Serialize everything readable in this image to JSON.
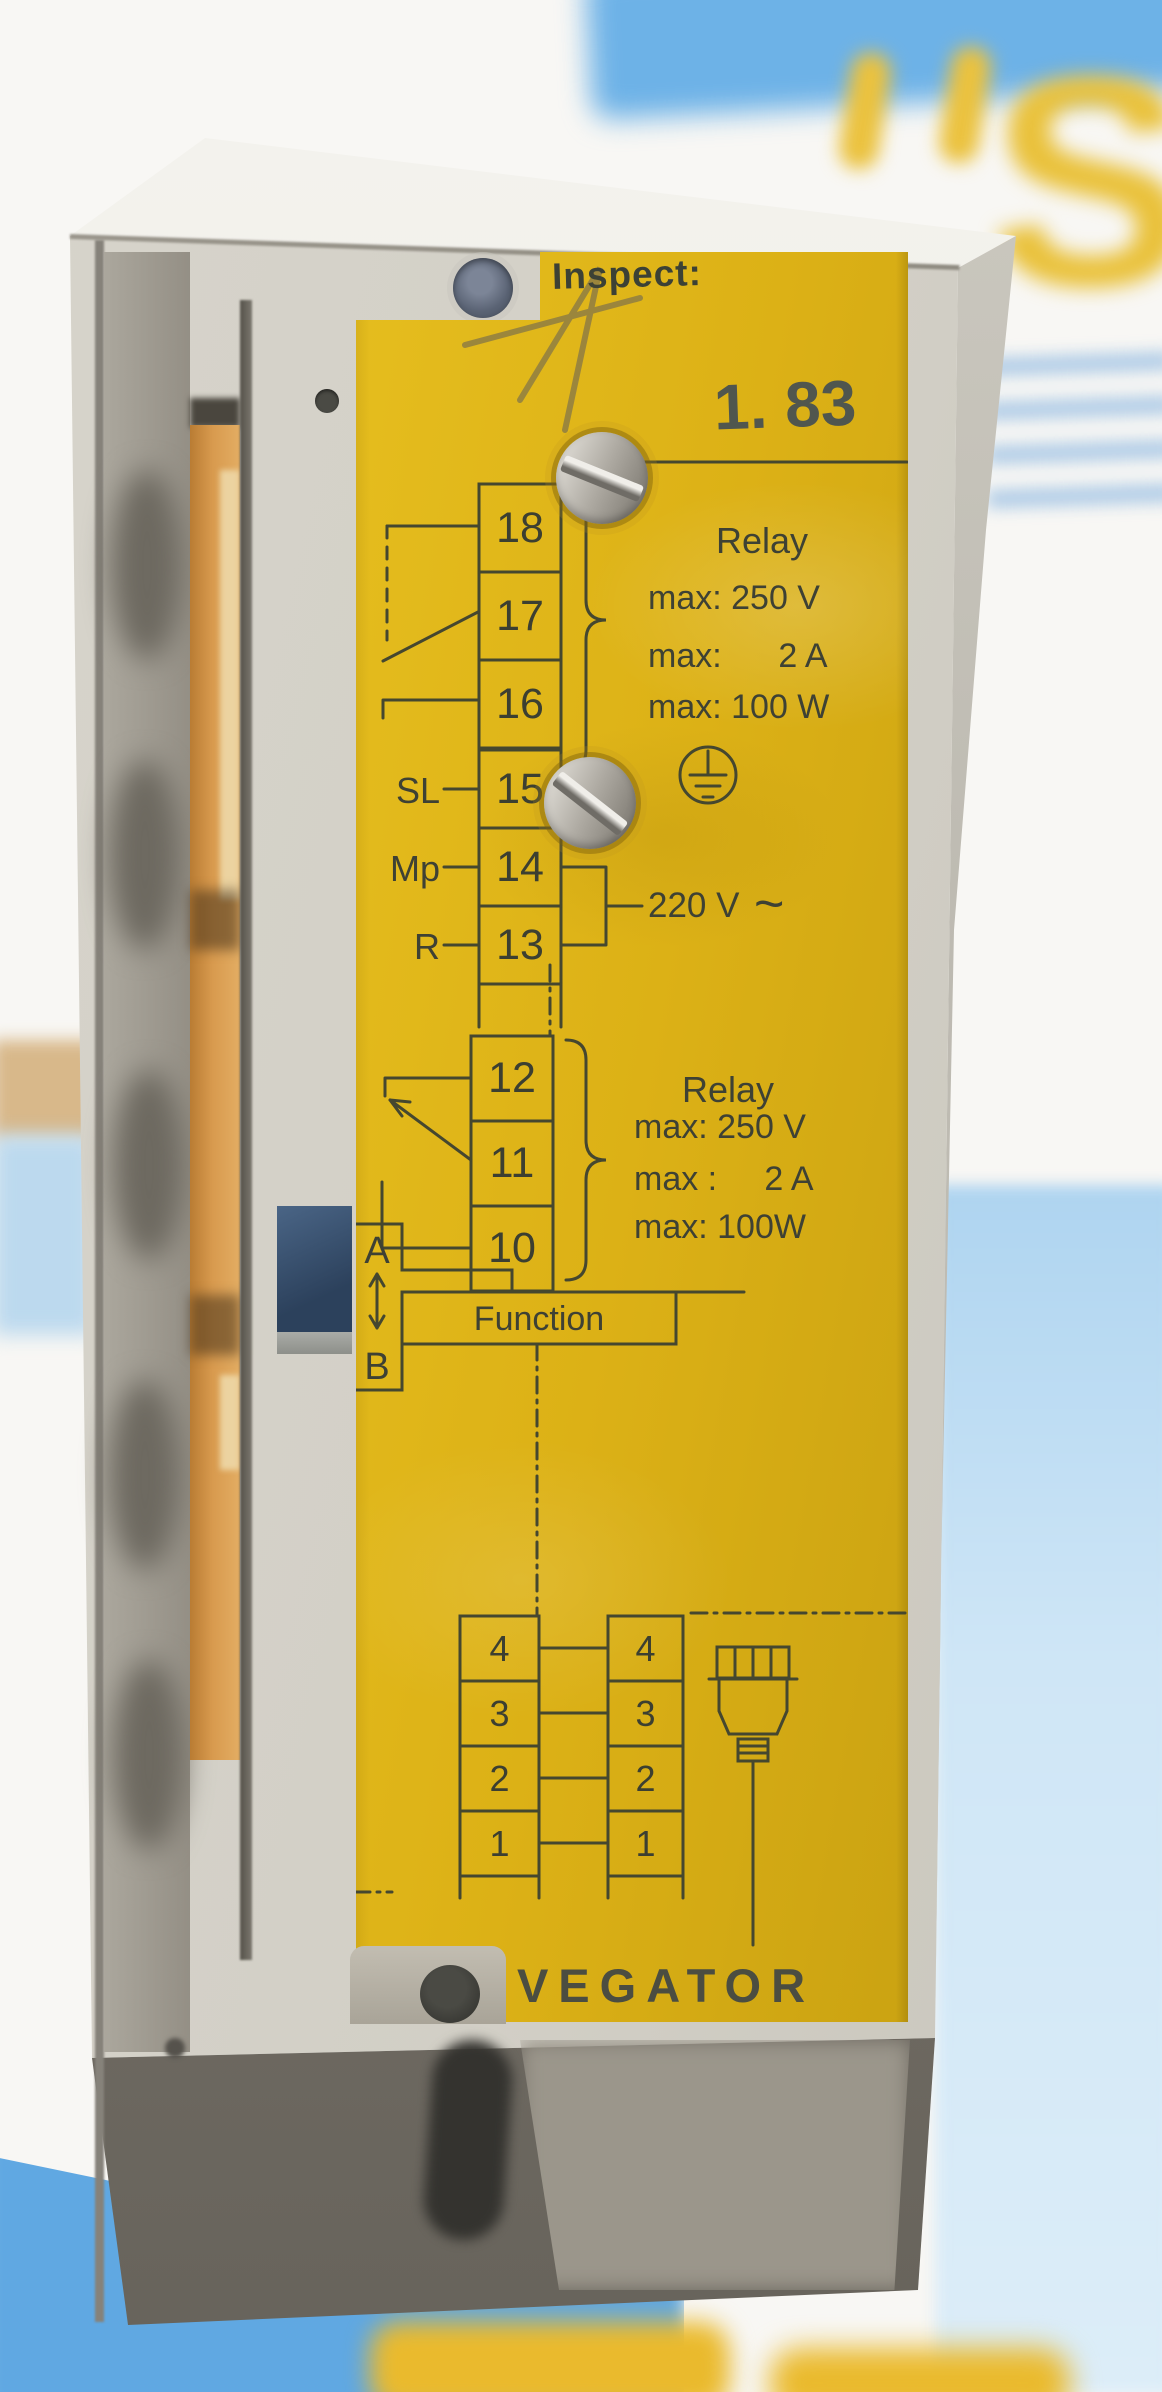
{
  "background": {
    "watermark_letter": "S"
  },
  "label": {
    "inspect": "Inspect:",
    "stamp": "1. 83",
    "brand": "VEGATOR",
    "relay_top": {
      "title": "Relay",
      "spec_voltage": "max: 250 V",
      "spec_current": "max:      2 A",
      "spec_power": "max: 100 W"
    },
    "relay_bottom": {
      "title": "Relay",
      "spec_voltage": "max: 250 V",
      "spec_current": "max :     2 A",
      "spec_power": "max: 100W"
    },
    "supply_voltage": "220 V",
    "ac_tilde": "~",
    "terminals_relay_top": [
      "18",
      "17",
      "16"
    ],
    "supply_rows": [
      {
        "label": "SL",
        "terminal": "15"
      },
      {
        "label": "Mp",
        "terminal": "14"
      },
      {
        "label": "R",
        "terminal": "13"
      }
    ],
    "function": {
      "label": "Function",
      "pos_top": "A",
      "pos_bottom": "B"
    },
    "probe_terminals_left": [
      "4",
      "3",
      "2",
      "1"
    ],
    "probe_terminals_right": [
      "4",
      "3",
      "2",
      "1"
    ]
  }
}
